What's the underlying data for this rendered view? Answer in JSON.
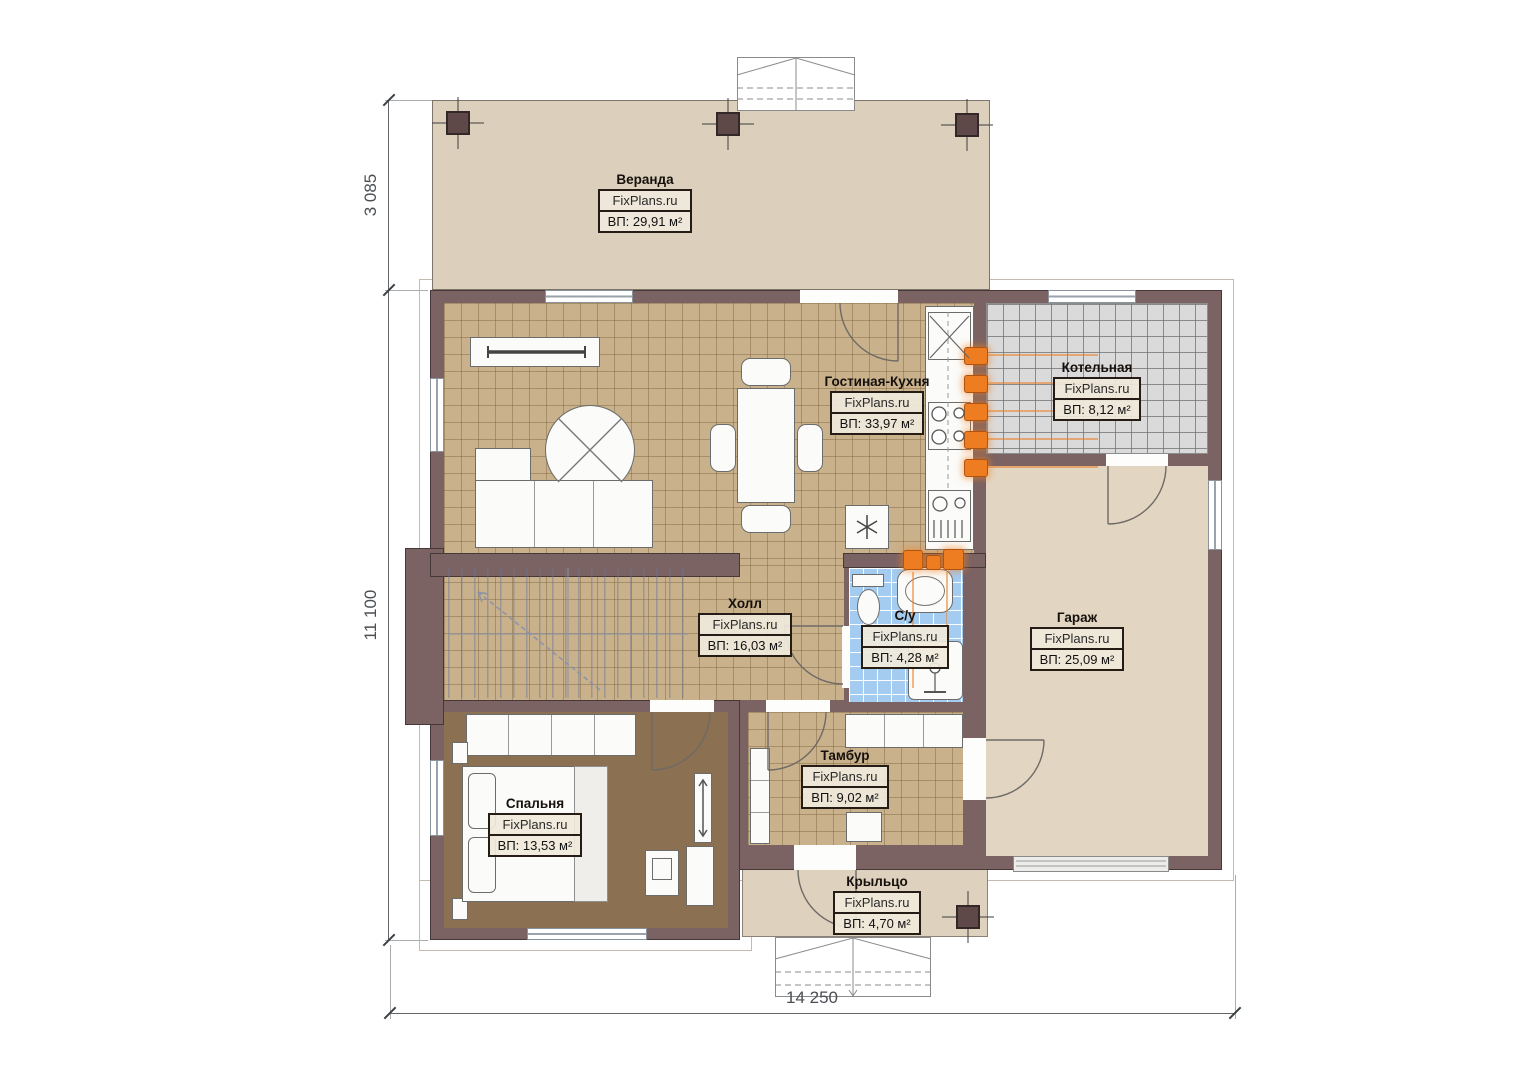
{
  "plan": {
    "brand": "FixPlans.ru",
    "rooms": [
      {
        "key": "veranda",
        "name": "Веранда",
        "area": "ВП: 29,91 м²"
      },
      {
        "key": "living-kitchen",
        "name": "Гостиная-Кухня",
        "area": "ВП: 33,97 м²"
      },
      {
        "key": "boiler",
        "name": "Котельная",
        "area": "ВП: 8,12 м²"
      },
      {
        "key": "hall",
        "name": "Холл",
        "area": "ВП: 16,03 м²"
      },
      {
        "key": "bathroom",
        "name": "С/у",
        "area": "ВП: 4,28 м²"
      },
      {
        "key": "garage",
        "name": "Гараж",
        "area": "ВП: 25,09 м²"
      },
      {
        "key": "tambur",
        "name": "Тамбур",
        "area": "ВП: 9,02 м²"
      },
      {
        "key": "bedroom",
        "name": "Спальня",
        "area": "ВП: 13,53 м²"
      },
      {
        "key": "porch",
        "name": "Крыльцо",
        "area": "ВП: 4,70 м²"
      }
    ],
    "dimensions": {
      "veranda_depth": "3 085",
      "house_side": "11 100",
      "house_front": "14 250"
    },
    "colors": {
      "wall": "#7b6363",
      "tile_floor": "#c9b18c",
      "veranda_floor": "#dccfbb",
      "garage_floor": "#e2d6c2",
      "bedroom_floor": "#8b7052",
      "bathroom_tile": "#a4cbf0",
      "boiler_tile": "#dadada",
      "radiator": "#ec7a20"
    }
  }
}
